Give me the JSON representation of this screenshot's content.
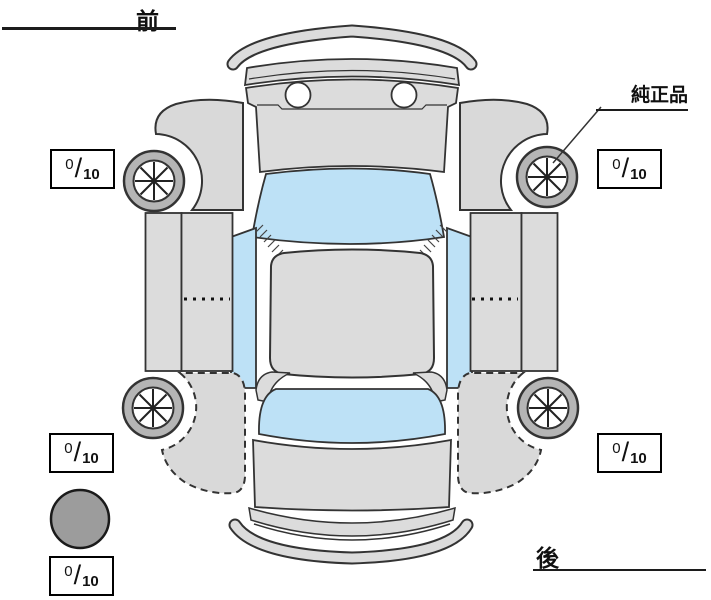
{
  "labels": {
    "front": "前",
    "rear": "後",
    "genuine_part": "純正品"
  },
  "tread_ratings": {
    "front_left": {
      "value": "0",
      "separator": "/",
      "max": "10"
    },
    "front_right": {
      "value": "0",
      "separator": "/",
      "max": "10"
    },
    "rear_left": {
      "value": "0",
      "separator": "/",
      "max": "10"
    },
    "rear_right": {
      "value": "0",
      "separator": "/",
      "max": "10"
    },
    "spare": {
      "value": "0",
      "separator": "/",
      "max": "10"
    }
  },
  "colors": {
    "background": "#ffffff",
    "body_gray": "#dcdcdc",
    "fender_gray": "#d9d9d9",
    "glass_blue": "#bde1f6",
    "wheel_ring": "#b5b5b5",
    "spare_tire": "#9c9c9c",
    "outline": "#333333",
    "text": "#101010"
  }
}
